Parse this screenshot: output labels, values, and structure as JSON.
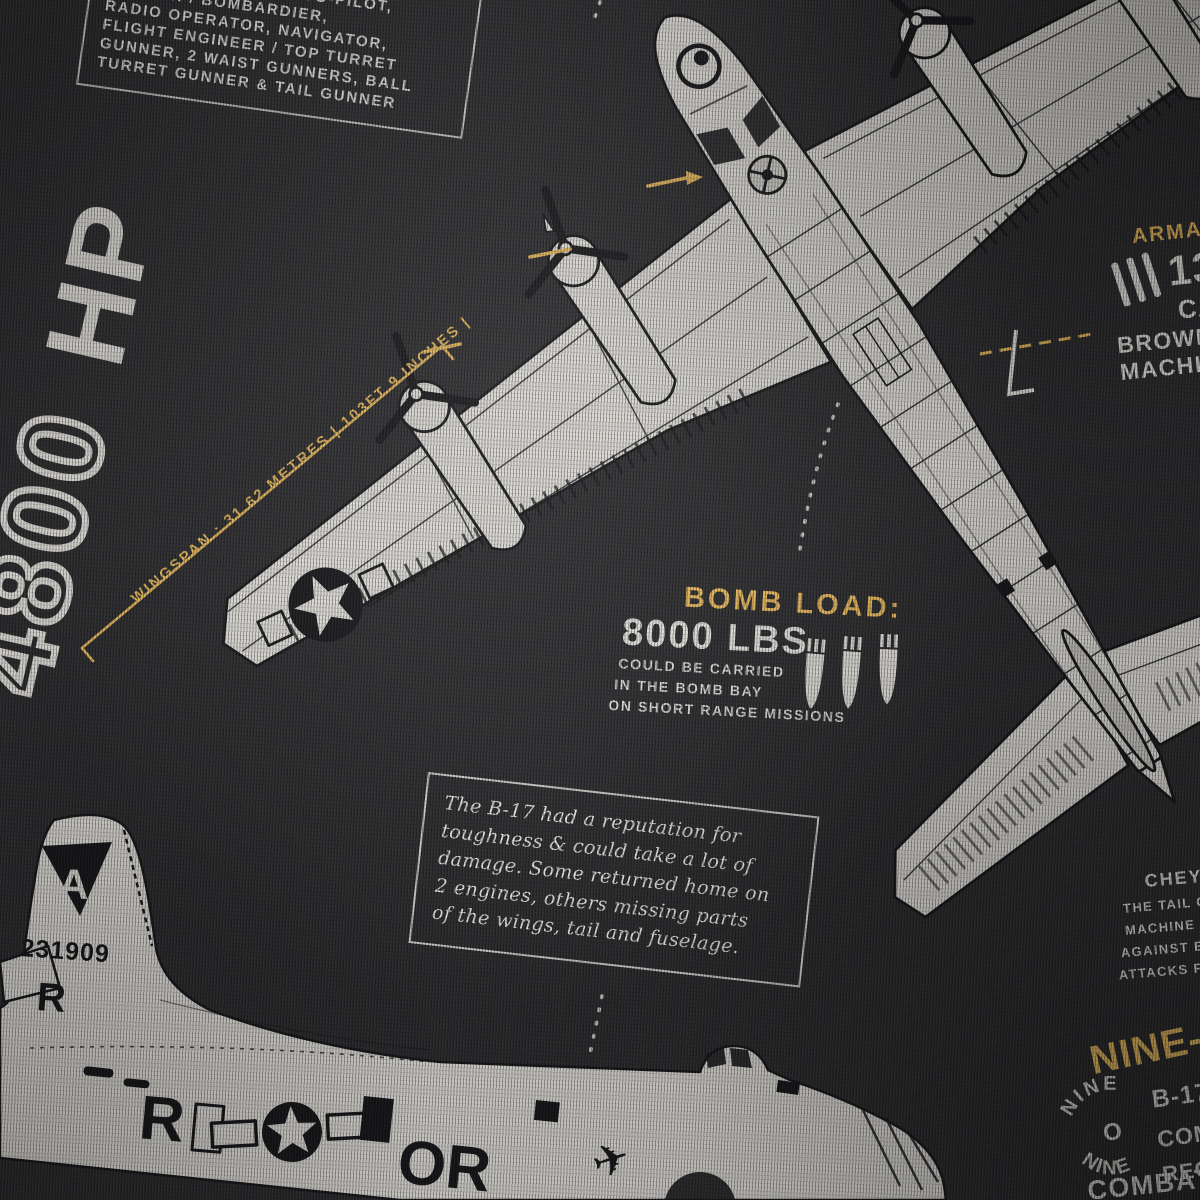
{
  "colors": {
    "fabric": "#2b2b2d",
    "print_white": "#d7d5d0",
    "accent_yellow": "#dfb259",
    "ink_black": "#17171a"
  },
  "crew_box": {
    "lines": [
      "CREW OF 10 : PILOT, CO-PILOT,",
      "GUNNER / BOMBARDIER,",
      "RADIO OPERATOR, NAVIGATOR,",
      "FLIGHT ENGINEER / TOP TURRET",
      "GUNNER, 2 WAIST GUNNERS, BALL",
      "TURRET GUNNER & TAIL GUNNER"
    ]
  },
  "power_rating": {
    "outline_text": "4800",
    "solid_text": "HP"
  },
  "wingspan": {
    "label": "WINGSPAN : 31.62 METRES | 103FT 9 INCHES |"
  },
  "armament": {
    "heading": "ARMAMENT:",
    "count": "13 ×",
    "line_caliber": "CALIBER",
    "line_brand": "BROWNING",
    "line_type": "MACHINE GUNS"
  },
  "bomb_load": {
    "heading": "BOMB LOAD:",
    "weight": "8000 LBS",
    "lines": [
      "COULD BE CARRIED",
      "IN THE BOMB BAY",
      "ON SHORT RANGE MISSIONS"
    ]
  },
  "reputation_note": {
    "lines": [
      "The B-17 had a reputation for",
      "toughness & could take a lot of",
      "damage. Some returned home on",
      "2 engines, others missing parts",
      "of the wings, tail and fuselage."
    ]
  },
  "tail_defense": {
    "heading": "CHEYENNE",
    "lines": [
      "THE TAIL GUNNER",
      "MACHINE GUNS",
      "AGAINST ENEMY",
      "ATTACKS FROM"
    ]
  },
  "nine_o_nine": {
    "heading": "NINE-O-NINE",
    "roundel_top": "NINE",
    "roundel_center": "O",
    "roundel_bottom": "NINE",
    "column_lines": [
      "B-17G",
      "COMPLETED",
      "RECORD"
    ],
    "bottom_line": "COMBAT MISSIONS"
  },
  "side_view_markings": {
    "group_letter": "A",
    "serial": "231909",
    "fin_code": "R",
    "fuselage_code_left": "R",
    "fuselage_code_right": "OR",
    "emblem_glyph": "✈"
  }
}
